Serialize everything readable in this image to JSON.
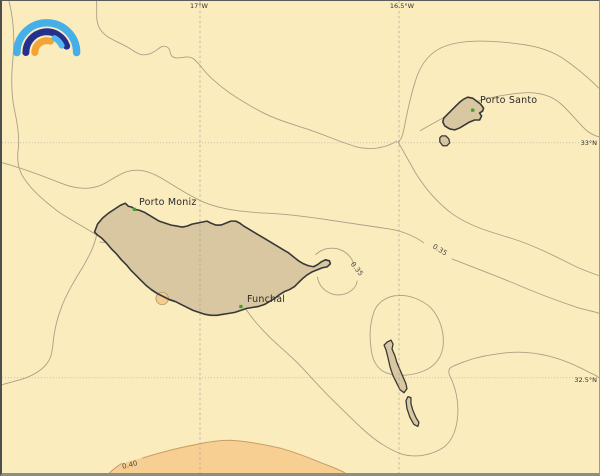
{
  "map": {
    "logo": {
      "name": "rainbow-arcs-logo",
      "arc_colors": {
        "outer_light_blue": "#47AFE8",
        "middle_navy": "#25308C",
        "inner_orange": "#F2A536",
        "inner_light_blue": "#4FB9EC"
      }
    },
    "graticule": {
      "meridians": [
        {
          "label": "17°W"
        },
        {
          "label": "16.5°W"
        }
      ],
      "parallels": [
        {
          "label": "33°N"
        },
        {
          "label": "32.5°N"
        }
      ]
    },
    "places": [
      {
        "name": "Porto Moniz"
      },
      {
        "name": "Funchal"
      },
      {
        "name": "Porto Santo"
      }
    ],
    "contour_labels": [
      {
        "value": "0.35"
      },
      {
        "value": "0.35"
      },
      {
        "value": "0.40"
      }
    ],
    "colors": {
      "background": "#FBECBD",
      "land_fill": "#D8C7A1",
      "coastline": "#383838",
      "contour_line": "#A9A086",
      "contour_fill": "#F8CF92",
      "contour_fill_edge": "#C79E66",
      "grid_line": "#9A9A9A",
      "city_marker_green": "#33A51F",
      "place_text": "#2B2B2B",
      "coord_text": "#333333",
      "contour_text": "#4A4A4A",
      "frame": "#8E8E7E"
    }
  }
}
